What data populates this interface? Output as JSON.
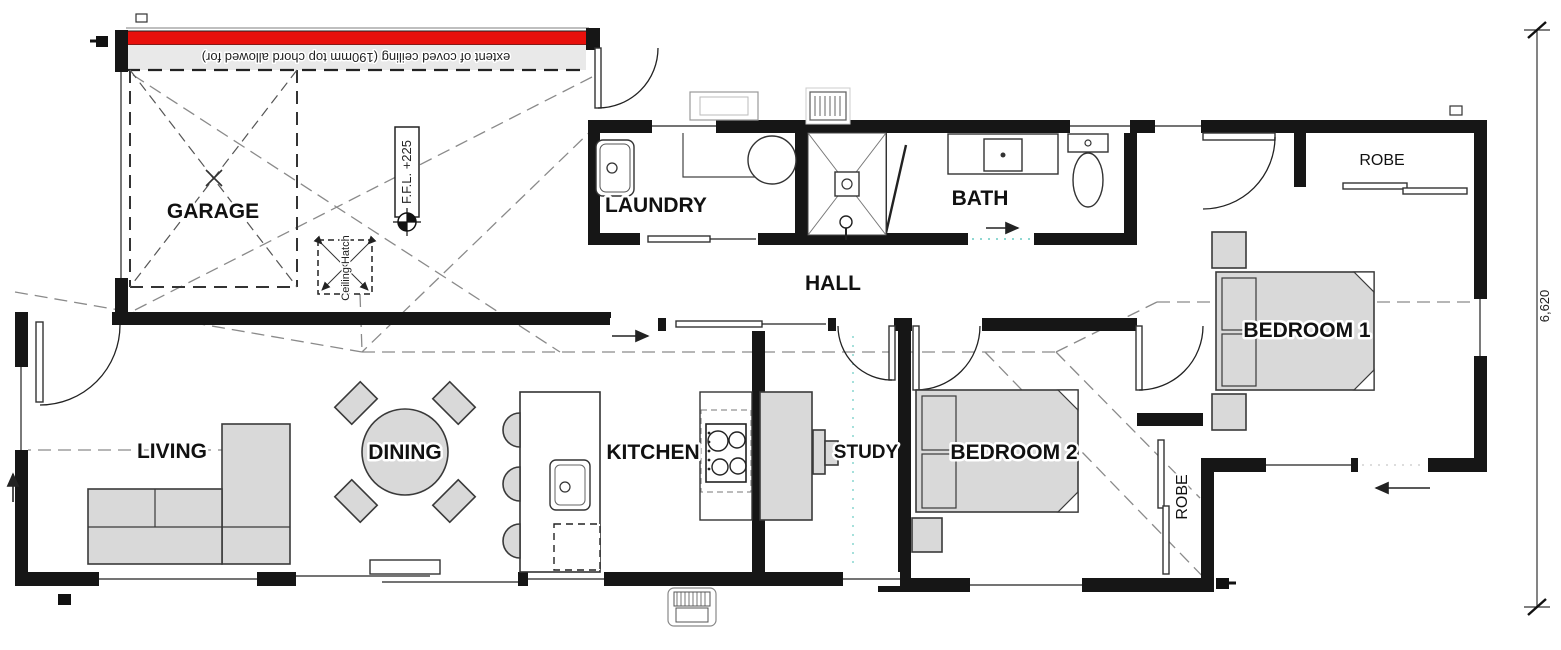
{
  "plan": {
    "rooms": {
      "garage": {
        "label": "GARAAGE_FIX",
        "x": 213,
        "y": 218
      },
      "laundry": {
        "label": "LAUNDRY"
      },
      "bath": {
        "label": "BATH"
      },
      "hall": {
        "label": "HALL"
      },
      "robe1": {
        "label": "ROBE"
      },
      "bedroom1": {
        "label": "BEDROOM 1"
      },
      "living": {
        "label": "LIVING"
      },
      "dining": {
        "label": "DINING"
      },
      "kitchen": {
        "label": "KITCHEN"
      },
      "study": {
        "label": "STUDY"
      },
      "bedroom2": {
        "label": "BEDROOM 2"
      },
      "robe2": {
        "label": "ROBE"
      }
    },
    "annotations": {
      "coved_ceiling": "extent of coved ceiling (190mm top chord allowed for)",
      "ffl": "F.F.L. +225",
      "ceiling_hatch": "Ceiling Hatch"
    },
    "dimensions": {
      "side_height": "6,620"
    },
    "colors": {
      "garage_door_red": "#e8100c",
      "ceiling_band": "#e9e9e9",
      "wall": "#161616",
      "furniture_fill": "#d9d9d9",
      "roof_dash": "#8a8a8a",
      "teal_dots": "#8fd8d2"
    }
  }
}
